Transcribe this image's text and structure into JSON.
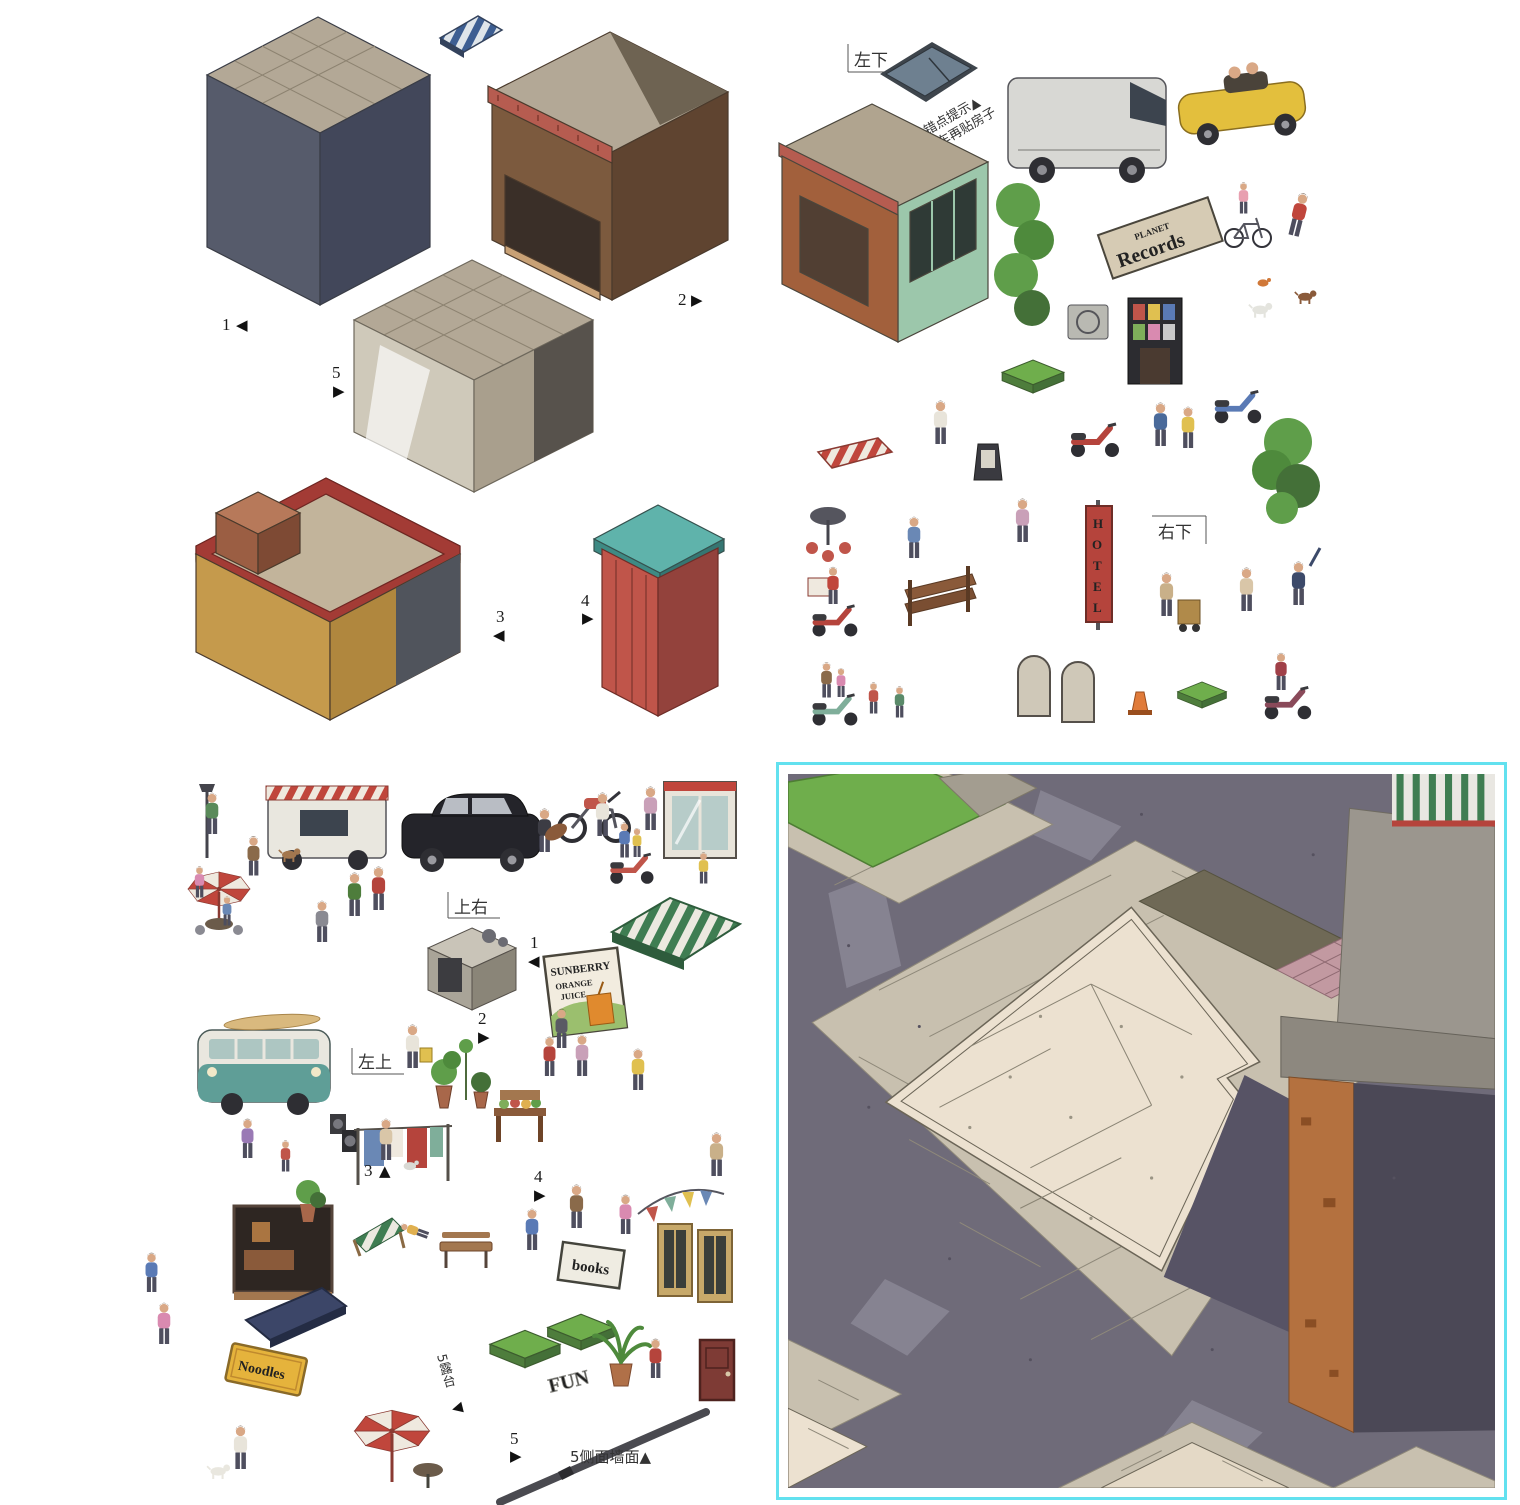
{
  "colors": {
    "frame_cyan": "#62e1ef",
    "hotel_red": "#b5443c",
    "records_green": "#3f7d5a",
    "noodles_yellow": "#e5b33c",
    "asphalt": "#6f6b79",
    "sidewalk": "#c8c0af",
    "pad_cream": "#ece1d0",
    "shadow_slate": "#575365",
    "wall_orange": "#b4713f",
    "grass_green": "#6fae4c"
  },
  "tl": {
    "labels": [
      {
        "n": "1",
        "a": "◀"
      },
      {
        "n": "2",
        "a": "▶"
      },
      {
        "n": "5",
        "a": "▶"
      },
      {
        "n": "3",
        "a": "◀"
      },
      {
        "n": "4",
        "a": "▶"
      }
    ]
  },
  "tr": {
    "tag_left_bottom": "左下",
    "tag_right_bottom": "右下",
    "tip_line1": "易错点提示▲",
    "tip_line2": "先贴车再贴房子",
    "records_top": "PLANET",
    "records_main": "Records",
    "hotel": [
      "H",
      "O",
      "T",
      "E",
      "L"
    ]
  },
  "bl": {
    "tag_top_right": "上右",
    "tag_left_top": "左上",
    "labels": [
      {
        "n": "1",
        "a": "◀"
      },
      {
        "n": "2",
        "a": "▶"
      },
      {
        "n": "3",
        "a": "▲"
      },
      {
        "n": "4",
        "a": "▶"
      },
      {
        "n": "5",
        "a": "▶"
      }
    ],
    "billboard": {
      "line1": "SUNBERRY",
      "line2": "ORANGE",
      "line3": "JUICE"
    },
    "noodles": "Noodles",
    "books": "books",
    "fun": "FUN",
    "terrace": "5露台",
    "terrace_arrow": "◀",
    "side_wall": "5侧面墙面▲"
  }
}
